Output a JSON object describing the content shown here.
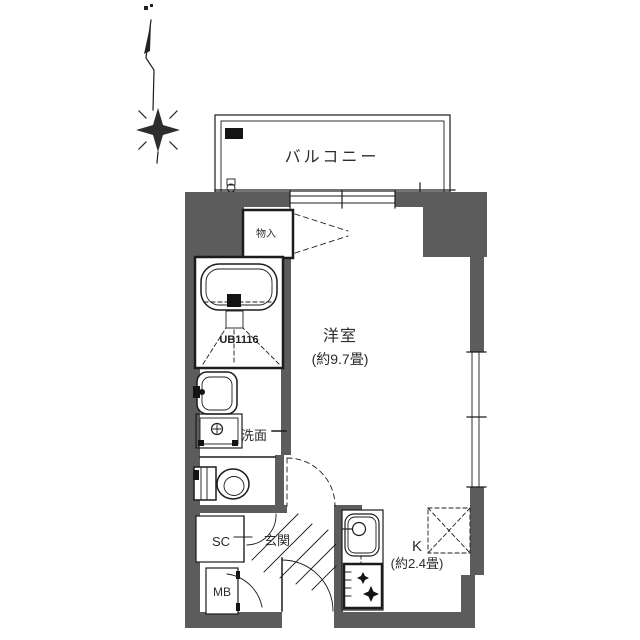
{
  "colors": {
    "wall": "#5c5c5c",
    "line": "#1c1c1c",
    "background": "#ffffff"
  },
  "rooms": {
    "balcony": {
      "label": "バルコニー"
    },
    "main_room": {
      "label": "洋室",
      "size": "(約9.7畳)"
    },
    "kitchen": {
      "label": "K",
      "size": "(約2.4畳)"
    },
    "unit_bath": {
      "label": "UB1116"
    },
    "washroom": {
      "label": "洗面"
    },
    "storage": {
      "label": "物入"
    },
    "entrance": {
      "label": "玄関"
    },
    "shoe_closet": {
      "label": "SC"
    },
    "meter_box": {
      "label": "MB"
    }
  }
}
